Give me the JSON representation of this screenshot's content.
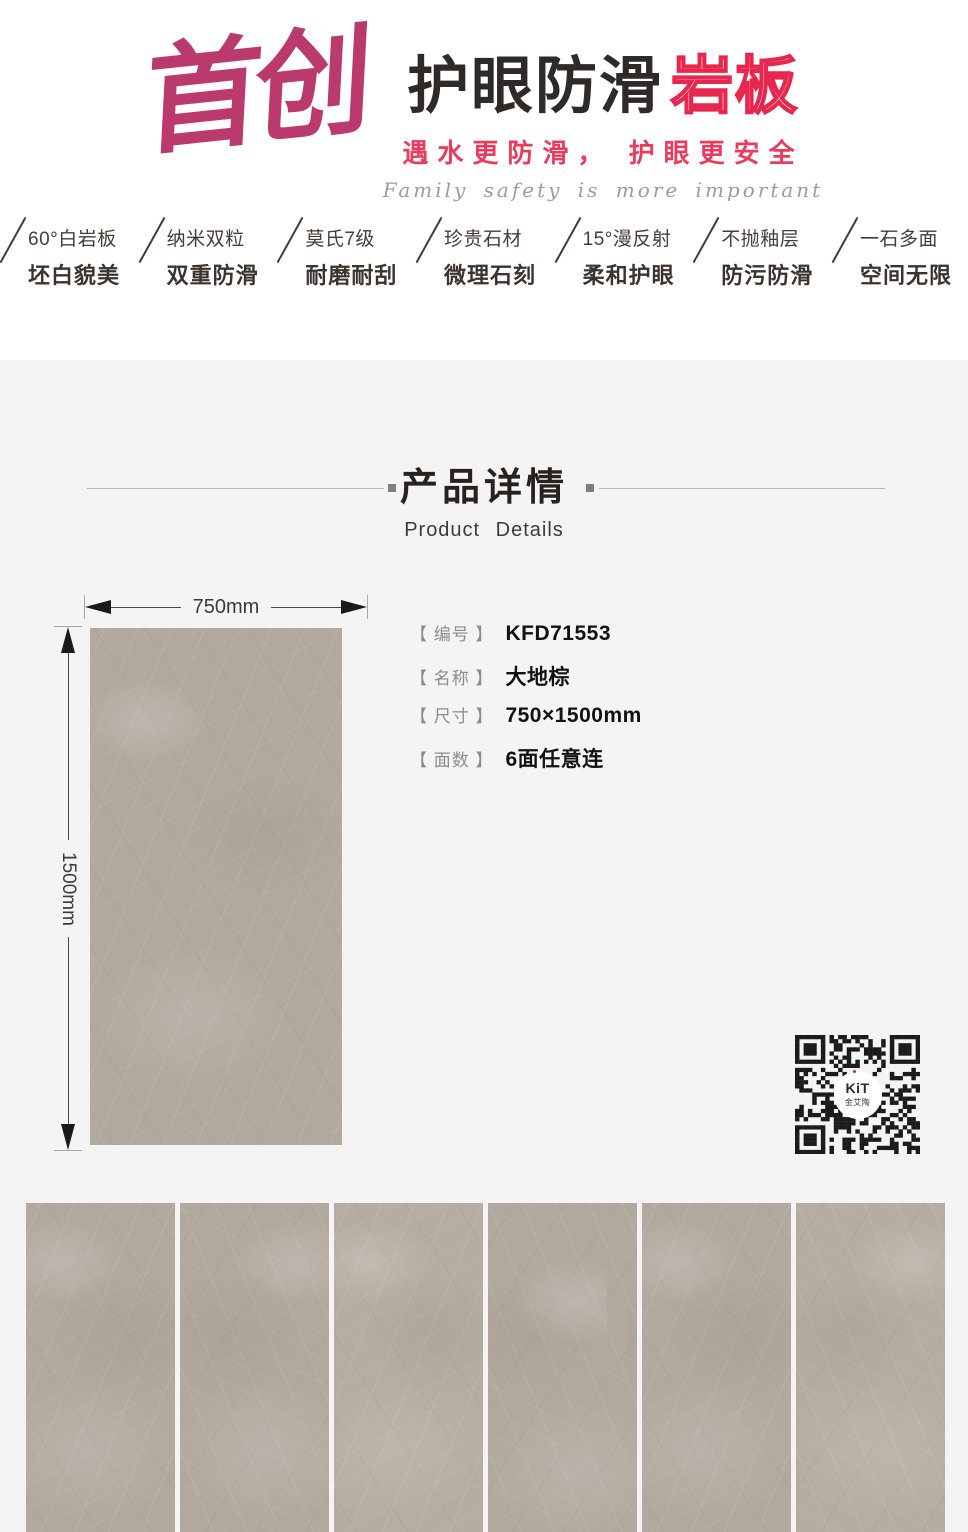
{
  "header": {
    "brand_calligraphy": "首创",
    "title_black": "护眼防滑",
    "title_pink": "岩板",
    "subtitle_cn": "遇水更防滑， 护眼更安全",
    "subtitle_en": "Family safety is more important"
  },
  "features": [
    {
      "line1": "60°白岩板",
      "line2": "坯白貌美"
    },
    {
      "line1": "纳米双粒",
      "line2": "双重防滑"
    },
    {
      "line1": "莫氏7级",
      "line2": "耐磨耐刮"
    },
    {
      "line1": "珍贵石材",
      "line2": "微理石刻"
    },
    {
      "line1": "15°漫反射",
      "line2": "柔和护眼"
    },
    {
      "line1": "不抛釉层",
      "line2": "防污防滑"
    },
    {
      "line1": "一石多面",
      "line2": "空间无限"
    }
  ],
  "section": {
    "title_cn": "产品详情",
    "title_en": "Product Details"
  },
  "product": {
    "dimension_width": "750mm",
    "dimension_height": "1500mm",
    "specs": [
      {
        "label": "【 编号 】",
        "value": "KFD71553"
      },
      {
        "label": "【 名称 】",
        "value": "大地棕"
      },
      {
        "label": "【 尺寸 】",
        "value": "750×1500mm"
      },
      {
        "label": "【 面数 】",
        "value": "6面任意连"
      }
    ]
  },
  "qr": {
    "logo_top": "KiT",
    "logo_bottom": "金艾陶"
  },
  "tiles": {
    "count": 6
  },
  "colors": {
    "brand_pink": "#bb3a6d",
    "accent_red": "#e7274e",
    "subtitle_pink": "#e73c5e",
    "text_dark": "#3b332e",
    "section_bg": "#f4f4f4",
    "tile_beige": "#b2a99e",
    "qr_module": "#1b1b1b"
  }
}
